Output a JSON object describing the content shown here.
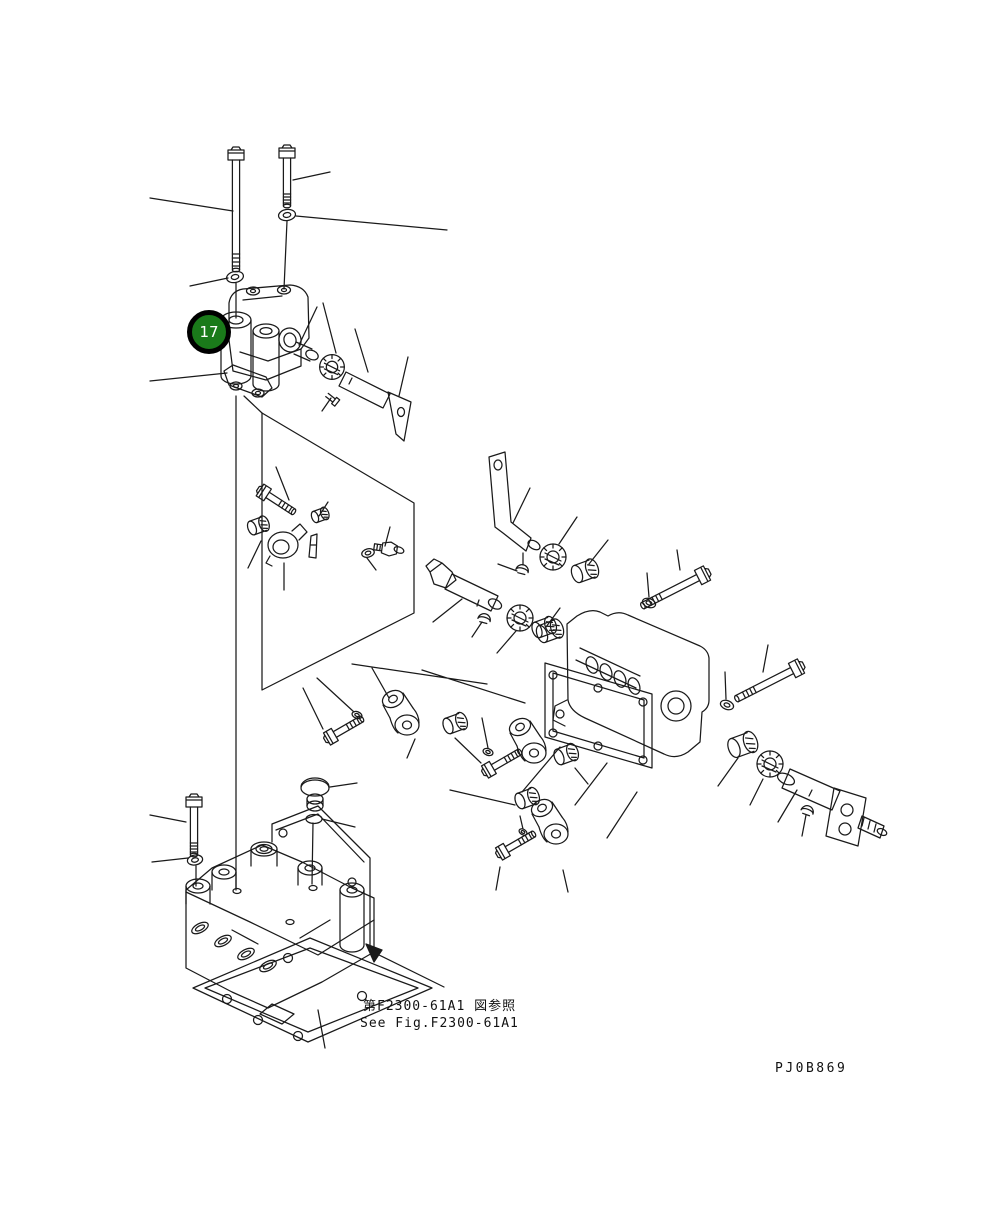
{
  "page": {
    "background": "#ffffff",
    "line_color": "#1a1a1a",
    "width": 1008,
    "height": 1224
  },
  "callout": {
    "number": "17",
    "fill": "#1a7a1a",
    "ring": "#000000",
    "text_color": "#ffffff"
  },
  "captions": {
    "reference_jp": "第F2300-61A1 図参照",
    "reference_en": "See Fig.F2300-61A1"
  },
  "drawing_code": "PJ0B869",
  "diagram": {
    "type": "exploded-parts-diagram",
    "parts": [
      "hex-bolt-long",
      "hex-bolt-short",
      "plain-washer",
      "valve-cover-assembly",
      "seal-bearing-disc",
      "lever-shaft",
      "set-screw",
      "detail-view-panel",
      "socket-bolt",
      "bushing",
      "lock-nut",
      "cam-lever",
      "seal-washer",
      "grease-fitting",
      "bracket-lever",
      "pin-shaft",
      "woodruff-key",
      "needle-bearing",
      "rocker-roller-assembly",
      "roller-cap",
      "mounting-bolt",
      "housing",
      "housing-gasket",
      "retainer-bushing",
      "seal-disc",
      "splined-shaft-with-flange",
      "plug-knob",
      "main-valve-body",
      "rear-mounting-plate",
      "body-gasket",
      "reference-arrow"
    ]
  }
}
